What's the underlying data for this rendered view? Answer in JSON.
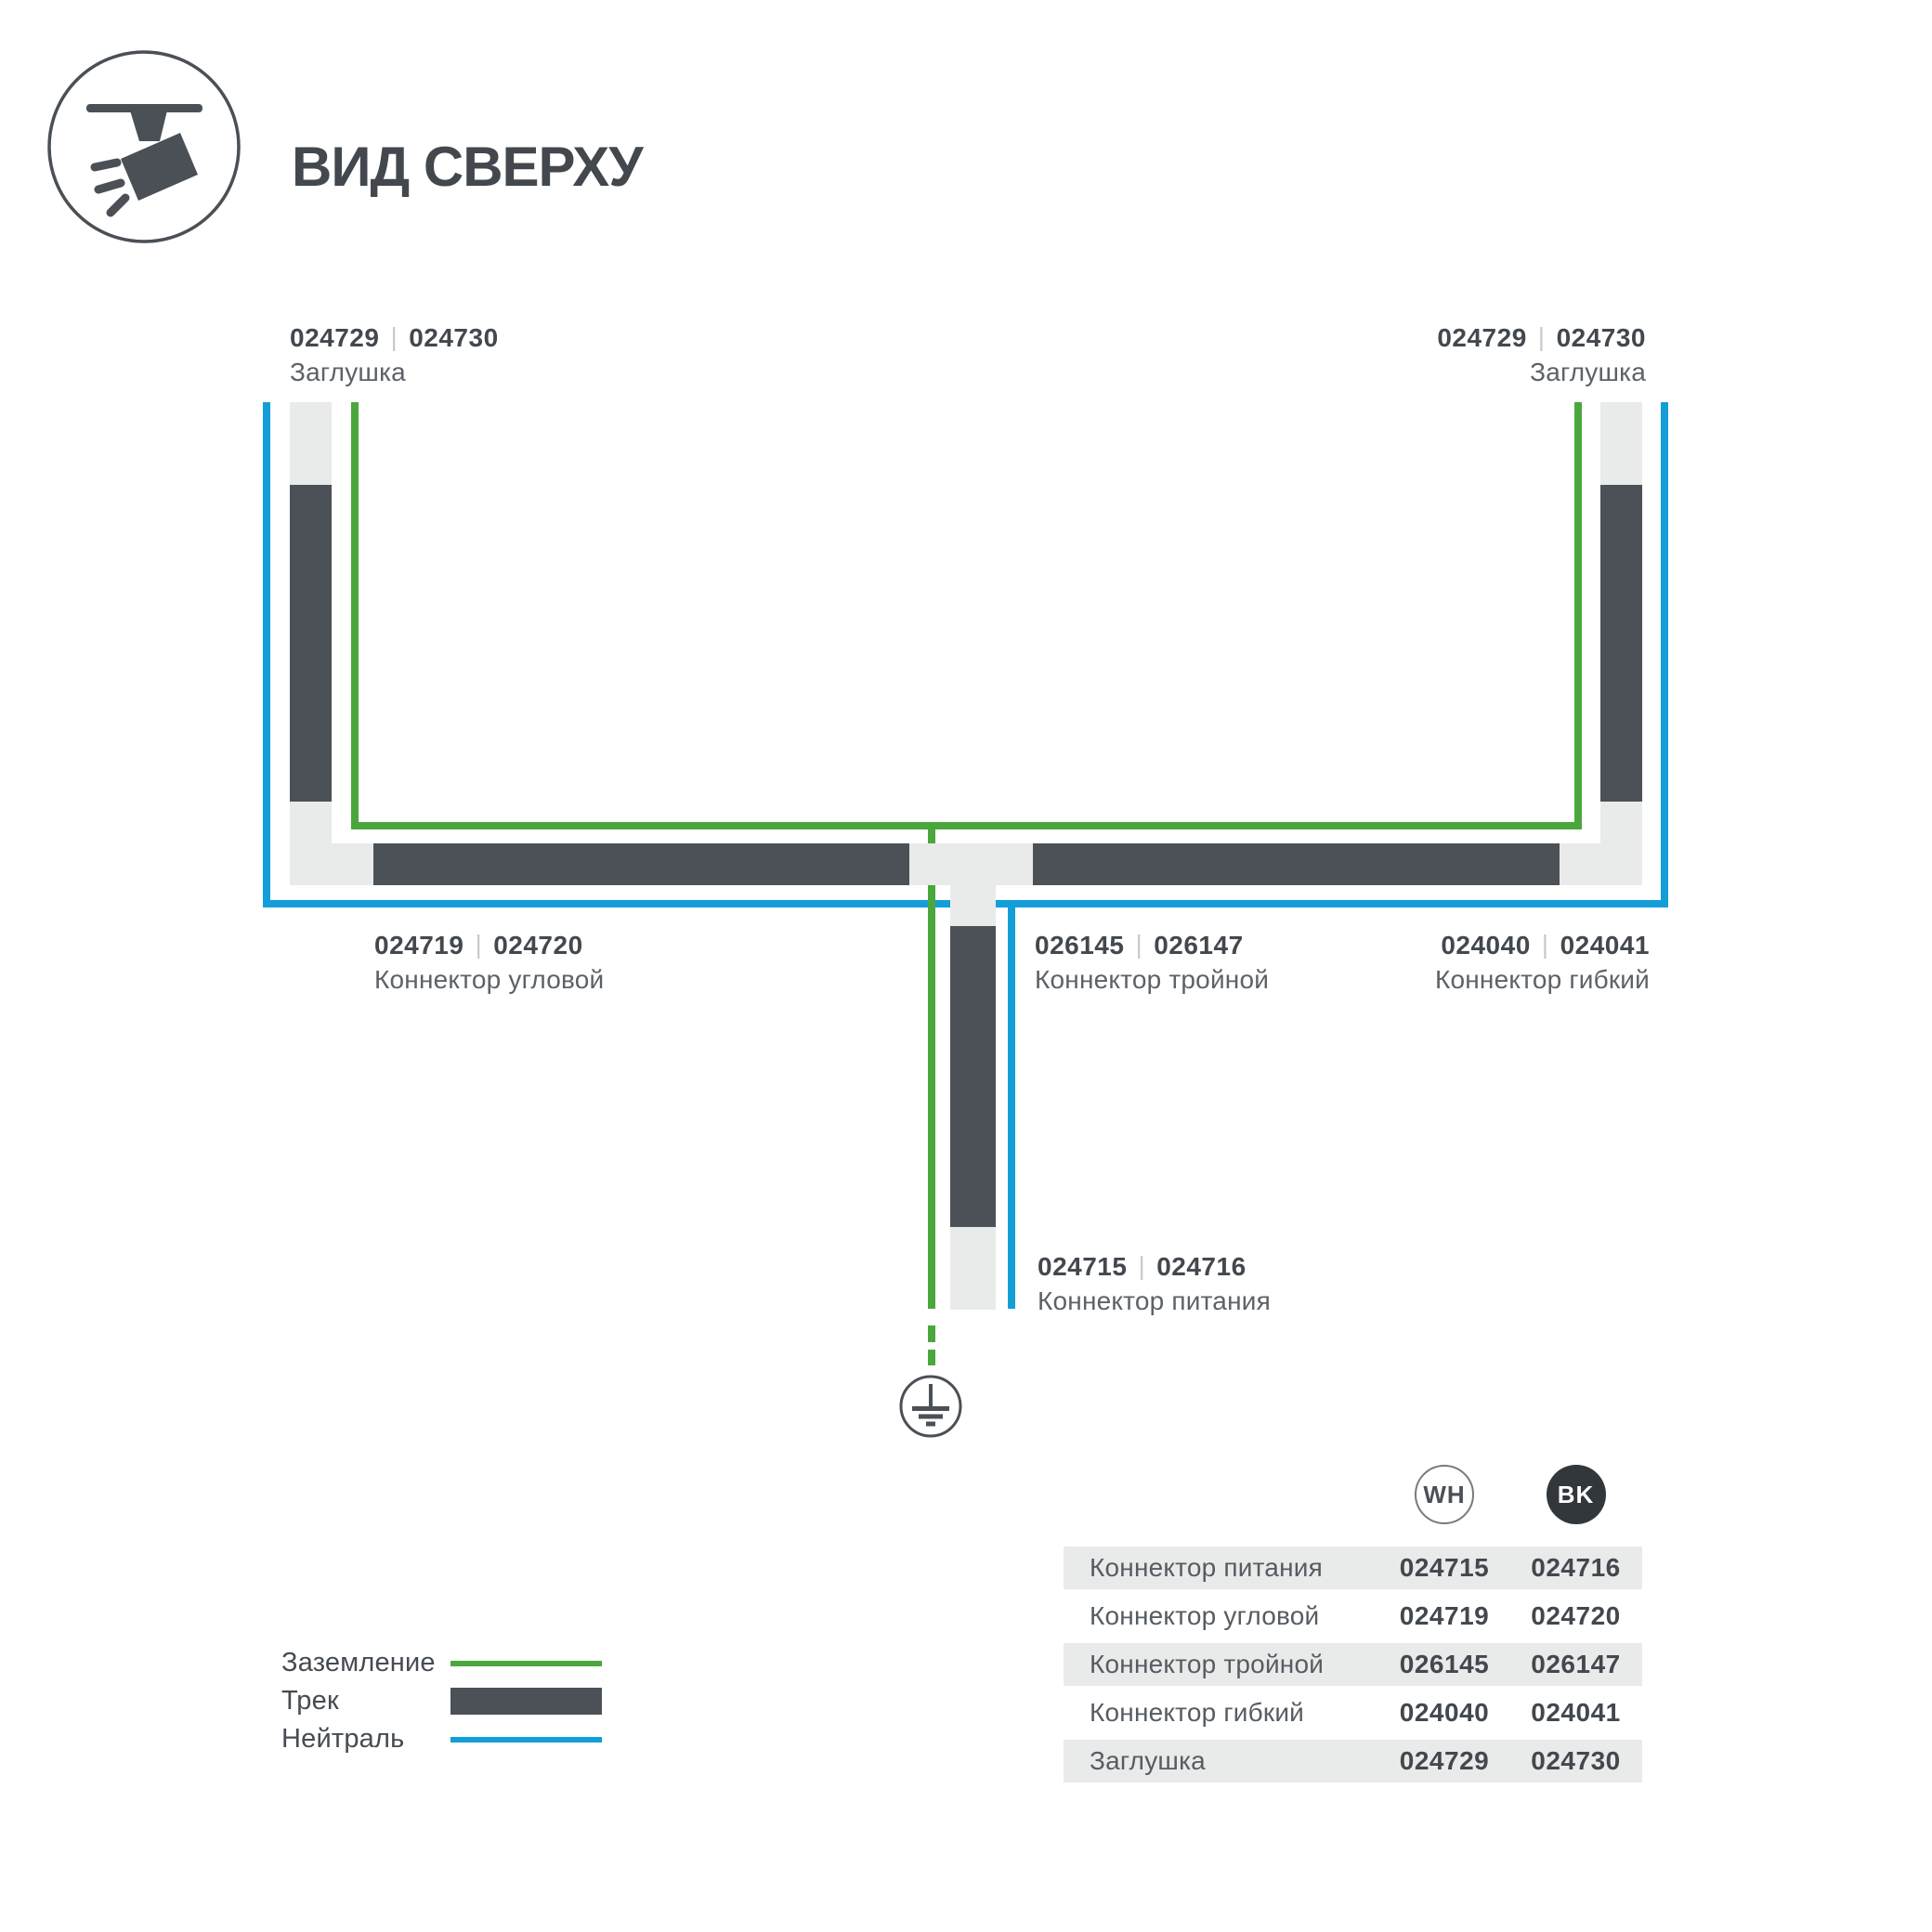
{
  "header": {
    "title": "ВИД СВЕРХУ"
  },
  "ui": {
    "code_separator": "|"
  },
  "colors": {
    "ground_green": "#4AA73C",
    "neutral_blue": "#149ED8",
    "track_dark": "#4B5157",
    "connector_light": "#E9EAEA",
    "text_dark": "#42484E",
    "text_muted": "#5C6268"
  },
  "parts": {
    "endcap": {
      "wh": "024729",
      "bk": "024730",
      "name": "Заглушка"
    },
    "corner": {
      "wh": "024719",
      "bk": "024720",
      "name": "Коннектор угловой"
    },
    "triple": {
      "wh": "026145",
      "bk": "026147",
      "name": "Коннектор тройной"
    },
    "flexible": {
      "wh": "024040",
      "bk": "024041",
      "name": "Коннектор гибкий"
    },
    "power": {
      "wh": "024715",
      "bk": "024716",
      "name": "Коннектор питания"
    }
  },
  "legend": {
    "items": [
      {
        "label": "Заземление",
        "type": "ground"
      },
      {
        "label": "Трек",
        "type": "track"
      },
      {
        "label": "Нейтраль",
        "type": "neutral"
      }
    ]
  },
  "table": {
    "columns": [
      {
        "id": "wh",
        "label": "WH"
      },
      {
        "id": "bk",
        "label": "BK"
      }
    ],
    "rows": [
      {
        "name": "Коннектор питания",
        "wh": "024715",
        "bk": "024716"
      },
      {
        "name": "Коннектор угловой",
        "wh": "024719",
        "bk": "024720"
      },
      {
        "name": "Коннектор тройной",
        "wh": "026145",
        "bk": "026147"
      },
      {
        "name": "Коннектор гибкий",
        "wh": "024040",
        "bk": "024041"
      },
      {
        "name": "Заглушка",
        "wh": "024729",
        "bk": "024730"
      }
    ]
  }
}
